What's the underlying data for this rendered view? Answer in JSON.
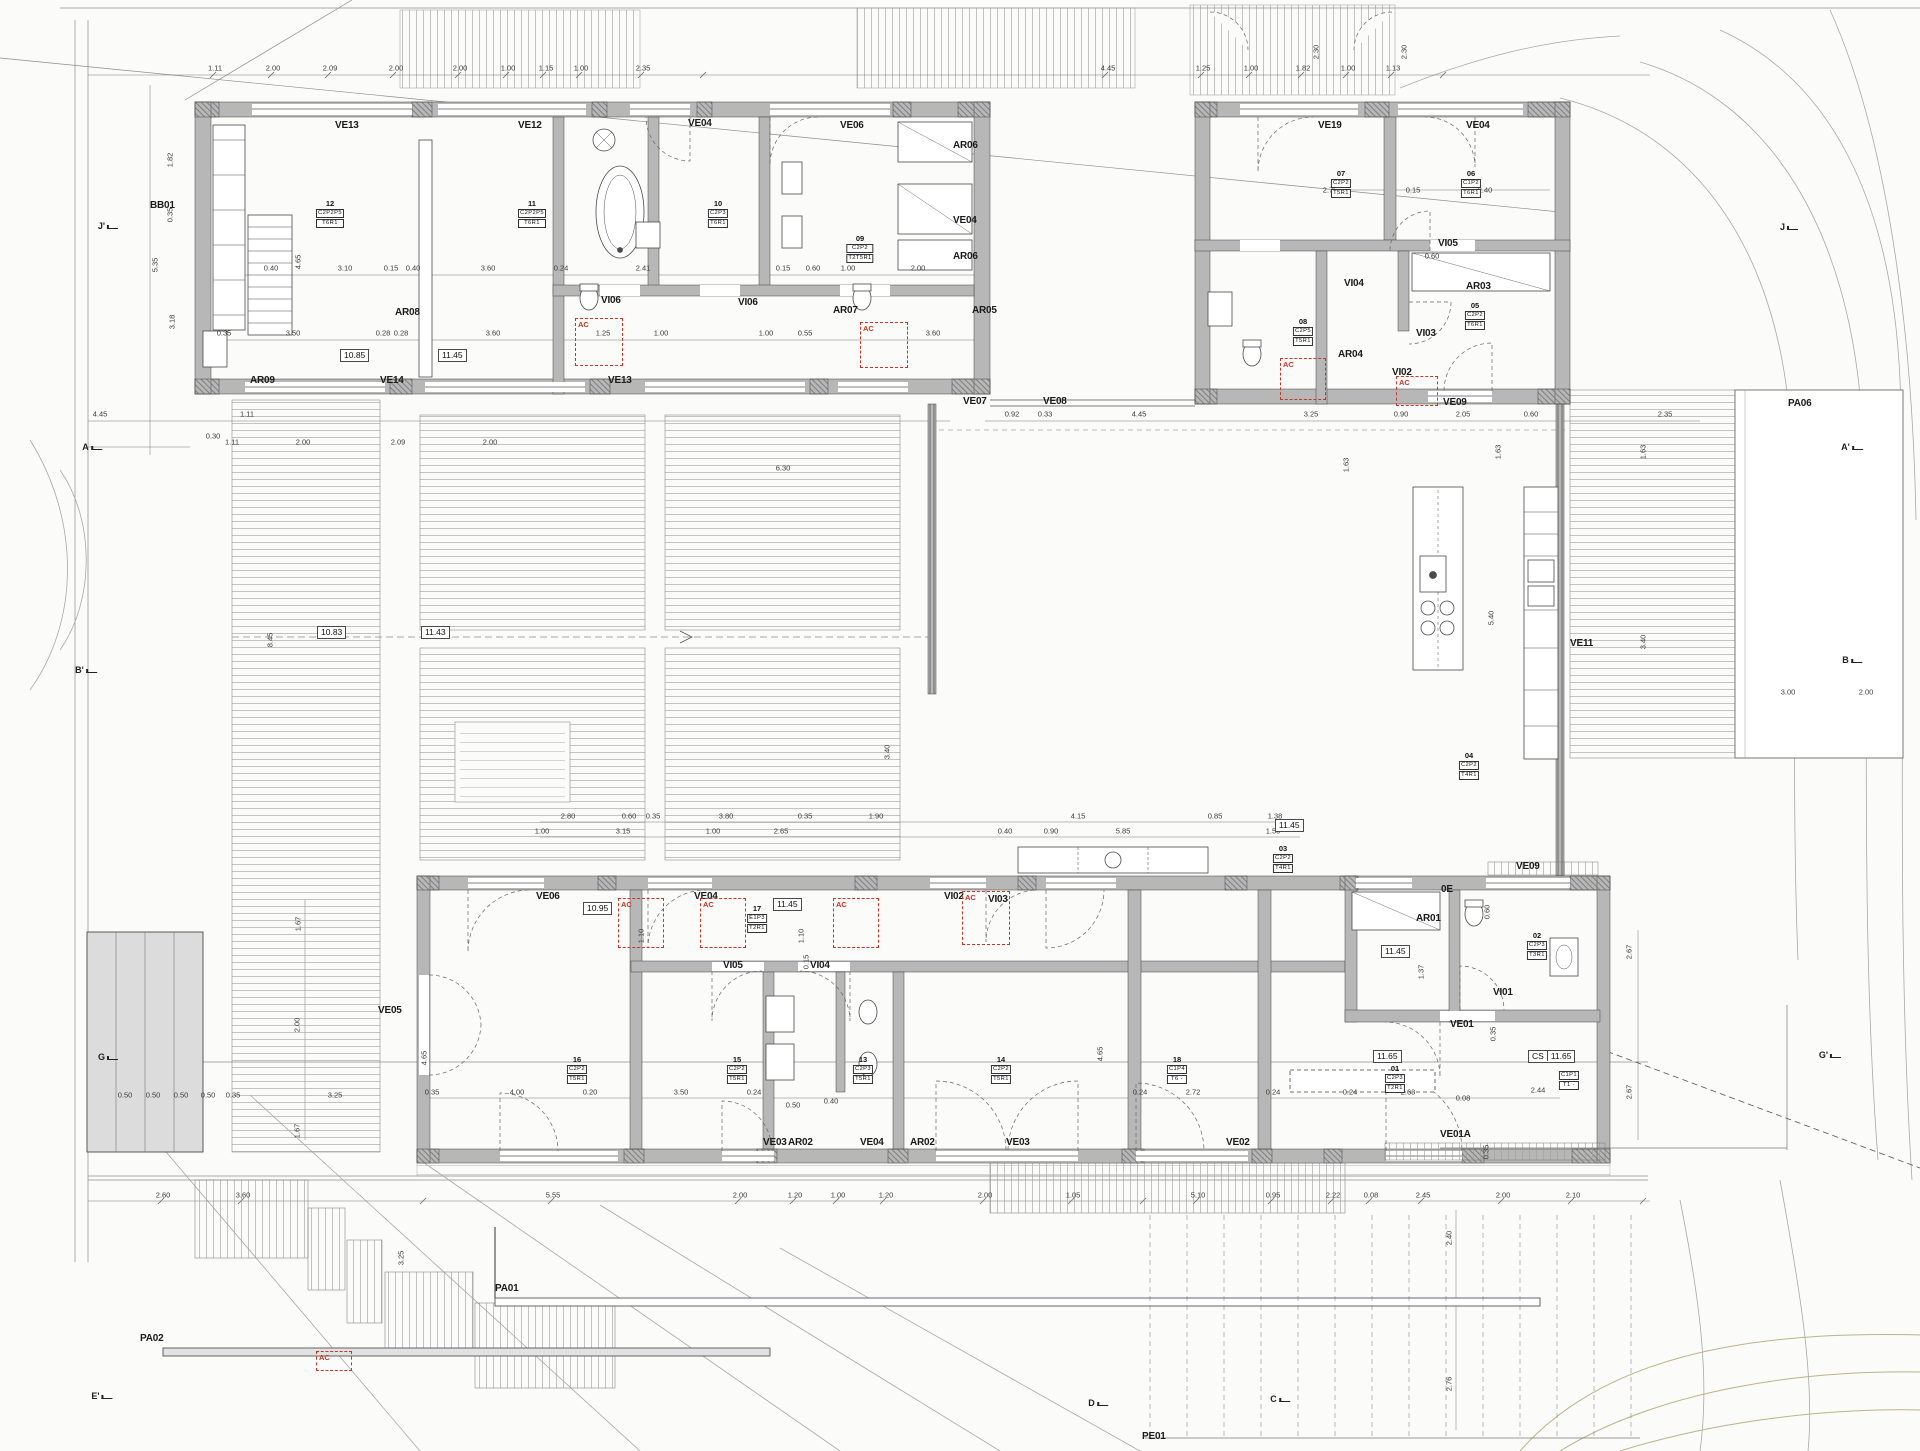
{
  "colors": {
    "wall_fill": "#b7b7b7",
    "pier_fill": "#9a9a9a",
    "line": "#555555",
    "deck_line": "#a9a9a9",
    "contour": "#a8a8a8",
    "vegetation": "#b9b489",
    "accent_red": "#c0392b",
    "paper": "#fbfbfa"
  },
  "ac_label": "AC",
  "ac_boxes": [
    {
      "x": 575,
      "y": 318,
      "w": 46,
      "h": 46
    },
    {
      "x": 860,
      "y": 322,
      "w": 46,
      "h": 44
    },
    {
      "x": 1280,
      "y": 358,
      "w": 44,
      "h": 40
    },
    {
      "x": 1396,
      "y": 376,
      "w": 40,
      "h": 28
    },
    {
      "x": 618,
      "y": 898,
      "w": 44,
      "h": 48
    },
    {
      "x": 700,
      "y": 898,
      "w": 44,
      "h": 48
    },
    {
      "x": 833,
      "y": 898,
      "w": 44,
      "h": 48
    },
    {
      "x": 962,
      "y": 891,
      "w": 46,
      "h": 52
    },
    {
      "x": 316,
      "y": 1351,
      "w": 34,
      "h": 18
    }
  ],
  "texts": {
    "bold": [
      {
        "t": "VE13",
        "x": 335,
        "y": 120
      },
      {
        "t": "VE12",
        "x": 518,
        "y": 120
      },
      {
        "t": "VE04",
        "x": 688,
        "y": 118
      },
      {
        "t": "VE06",
        "x": 840,
        "y": 120
      },
      {
        "t": "AR06",
        "x": 953,
        "y": 140
      },
      {
        "t": "VE04",
        "x": 953,
        "y": 215
      },
      {
        "t": "AR06",
        "x": 953,
        "y": 251
      },
      {
        "t": "AR05",
        "x": 972,
        "y": 305
      },
      {
        "t": "AR08",
        "x": 395,
        "y": 307
      },
      {
        "t": "AR07",
        "x": 833,
        "y": 305
      },
      {
        "t": "VI06",
        "x": 601,
        "y": 295
      },
      {
        "t": "VI06",
        "x": 738,
        "y": 297
      },
      {
        "t": "AR09",
        "x": 250,
        "y": 375
      },
      {
        "t": "VE14",
        "x": 380,
        "y": 375
      },
      {
        "t": "VE13",
        "x": 608,
        "y": 375
      },
      {
        "t": "BB01",
        "x": 150,
        "y": 200
      },
      {
        "t": "VE07",
        "x": 963,
        "y": 396
      },
      {
        "t": "VE08",
        "x": 1043,
        "y": 396
      },
      {
        "t": "VE19",
        "x": 1318,
        "y": 120
      },
      {
        "t": "VE04",
        "x": 1466,
        "y": 120
      },
      {
        "t": "VI05",
        "x": 1438,
        "y": 238
      },
      {
        "t": "VI04",
        "x": 1344,
        "y": 278
      },
      {
        "t": "AR03",
        "x": 1466,
        "y": 281
      },
      {
        "t": "VI03",
        "x": 1416,
        "y": 328
      },
      {
        "t": "AR04",
        "x": 1338,
        "y": 349
      },
      {
        "t": "VI02",
        "x": 1392,
        "y": 367
      },
      {
        "t": "VE09",
        "x": 1443,
        "y": 397
      },
      {
        "t": "VE11",
        "x": 1570,
        "y": 638
      },
      {
        "t": "PA06",
        "x": 1788,
        "y": 398
      },
      {
        "t": "VE09",
        "x": 1516,
        "y": 861
      },
      {
        "t": "VE06",
        "x": 536,
        "y": 891
      },
      {
        "t": "VE04",
        "x": 694,
        "y": 891
      },
      {
        "t": "VI02",
        "x": 944,
        "y": 891
      },
      {
        "t": "VI03",
        "x": 988,
        "y": 894
      },
      {
        "t": "VI05",
        "x": 723,
        "y": 960
      },
      {
        "t": "VI04",
        "x": 810,
        "y": 960
      },
      {
        "t": "AR01",
        "x": 1416,
        "y": 913
      },
      {
        "t": "0E",
        "x": 1441,
        "y": 884
      },
      {
        "t": "VE05",
        "x": 378,
        "y": 1005
      },
      {
        "t": "VE03",
        "x": 763,
        "y": 1137
      },
      {
        "t": "AR02",
        "x": 788,
        "y": 1137
      },
      {
        "t": "VE04",
        "x": 860,
        "y": 1137
      },
      {
        "t": "AR02",
        "x": 910,
        "y": 1137
      },
      {
        "t": "VE03",
        "x": 1006,
        "y": 1137
      },
      {
        "t": "VE02",
        "x": 1226,
        "y": 1137
      },
      {
        "t": "VE01",
        "x": 1450,
        "y": 1019
      },
      {
        "t": "VE01A",
        "x": 1440,
        "y": 1129
      },
      {
        "t": "VI01",
        "x": 1493,
        "y": 987
      },
      {
        "t": "PA01",
        "x": 495,
        "y": 1283
      },
      {
        "t": "PA02",
        "x": 140,
        "y": 1333
      },
      {
        "t": "PE01",
        "x": 1142,
        "y": 1431
      }
    ],
    "levels": [
      {
        "t": "10.85",
        "x": 340,
        "y": 349
      },
      {
        "t": "11.45",
        "x": 438,
        "y": 349
      },
      {
        "t": "10.83",
        "x": 317,
        "y": 626
      },
      {
        "t": "11.43",
        "x": 421,
        "y": 626
      },
      {
        "t": "10.95",
        "x": 583,
        "y": 902
      },
      {
        "t": "11.45",
        "x": 773,
        "y": 898
      },
      {
        "t": "11.45",
        "x": 1275,
        "y": 819
      },
      {
        "t": "11.45",
        "x": 1381,
        "y": 945
      },
      {
        "t": "11.65",
        "x": 1373,
        "y": 1050
      },
      {
        "p": "CS",
        "t": "11.65",
        "x": 1528,
        "y": 1050
      }
    ],
    "tags": [
      {
        "n": "12",
        "l1": "C2P2P5",
        "l2": "T6R1",
        "x": 330,
        "y": 200
      },
      {
        "n": "11",
        "l1": "C2P2P5",
        "l2": "T6R1",
        "x": 532,
        "y": 200
      },
      {
        "n": "10",
        "l1": "C2P3",
        "l2": "T6R1",
        "x": 718,
        "y": 200
      },
      {
        "n": "09",
        "l1": "C2P2",
        "l2": "T2T5R1",
        "x": 860,
        "y": 235
      },
      {
        "n": "08",
        "l1": "C2P5",
        "l2": "T5R1",
        "x": 1303,
        "y": 318
      },
      {
        "n": "07",
        "l1": "C2P2",
        "l2": "T5R1",
        "x": 1341,
        "y": 170
      },
      {
        "n": "06",
        "l1": "C1P2",
        "l2": "T6R1",
        "x": 1471,
        "y": 170
      },
      {
        "n": "05",
        "l1": "C2P2",
        "l2": "T6R1",
        "x": 1475,
        "y": 302
      },
      {
        "n": "04",
        "l1": "C2P2",
        "l2": "T4R1",
        "x": 1469,
        "y": 752
      },
      {
        "n": "03",
        "l1": "C2P2",
        "l2": "T4R1",
        "x": 1283,
        "y": 845
      },
      {
        "n": "02",
        "l1": "C2P3",
        "l2": "T3R1",
        "x": 1537,
        "y": 932
      },
      {
        "n": "01",
        "l1": "C2P3",
        "l2": "T2R1",
        "x": 1395,
        "y": 1065
      },
      {
        "n": "16",
        "l1": "C2P2",
        "l2": "T5R1",
        "x": 577,
        "y": 1056
      },
      {
        "n": "15",
        "l1": "C2P2",
        "l2": "T5R1",
        "x": 737,
        "y": 1056
      },
      {
        "n": "13",
        "l1": "C2P3",
        "l2": "T5R1",
        "x": 863,
        "y": 1056
      },
      {
        "n": "14",
        "l1": "C2P2",
        "l2": "T5R1",
        "x": 1001,
        "y": 1056
      },
      {
        "n": "17",
        "l1": "E1P3",
        "l2": "T2R1",
        "x": 757,
        "y": 905
      },
      {
        "n": "18",
        "l1": "C1P4",
        "l2": "T6 -",
        "x": 1177,
        "y": 1056
      },
      {
        "n": "",
        "l1": "C1P1",
        "l2": "T1 -",
        "x": 1569,
        "y": 1070
      }
    ],
    "sections": [
      {
        "t": "A",
        "x": 92,
        "y": 447
      },
      {
        "t": "A'",
        "x": 1852,
        "y": 447
      },
      {
        "t": "B",
        "x": 1852,
        "y": 660
      },
      {
        "t": "B'",
        "x": 86,
        "y": 670
      },
      {
        "t": "G",
        "x": 108,
        "y": 1057
      },
      {
        "t": "G'",
        "x": 1830,
        "y": 1055
      },
      {
        "t": "J",
        "x": 1789,
        "y": 227
      },
      {
        "t": "J'",
        "x": 108,
        "y": 226
      },
      {
        "t": "C",
        "x": 1280,
        "y": 1399
      },
      {
        "t": "D",
        "x": 1098,
        "y": 1403
      },
      {
        "t": "E'",
        "x": 102,
        "y": 1396
      }
    ],
    "dims": [
      {
        "t": "1.11",
        "x": 215,
        "y": 68
      },
      {
        "t": "2.00",
        "x": 273,
        "y": 68
      },
      {
        "t": "2.09",
        "x": 330,
        "y": 68
      },
      {
        "t": "2.00",
        "x": 396,
        "y": 68
      },
      {
        "t": "2.00",
        "x": 460,
        "y": 68
      },
      {
        "t": "1.00",
        "x": 508,
        "y": 68
      },
      {
        "t": "1.15",
        "x": 546,
        "y": 68
      },
      {
        "t": "1.00",
        "x": 581,
        "y": 68
      },
      {
        "t": "2.35",
        "x": 643,
        "y": 68
      },
      {
        "t": "4.45",
        "x": 1108,
        "y": 68
      },
      {
        "t": "1.25",
        "x": 1203,
        "y": 68
      },
      {
        "t": "1.00",
        "x": 1251,
        "y": 68
      },
      {
        "t": "1.82",
        "x": 1303,
        "y": 68
      },
      {
        "t": "1.00",
        "x": 1348,
        "y": 68
      },
      {
        "t": "1.13",
        "x": 1393,
        "y": 68
      },
      {
        "t": "2.30",
        "x": 1316,
        "y": 52,
        "r": 1
      },
      {
        "t": "2.30",
        "x": 1404,
        "y": 52,
        "r": 1
      },
      {
        "t": "1.82",
        "x": 170,
        "y": 160,
        "r": 1
      },
      {
        "t": "0.35",
        "x": 170,
        "y": 215,
        "r": 1
      },
      {
        "t": "5.35",
        "x": 155,
        "y": 265,
        "r": 1
      },
      {
        "t": "3.18",
        "x": 172,
        "y": 322,
        "r": 1
      },
      {
        "t": "4.65",
        "x": 298,
        "y": 262,
        "r": 1
      },
      {
        "t": "4.45",
        "x": 100,
        "y": 414
      },
      {
        "t": "0.30",
        "x": 213,
        "y": 436
      },
      {
        "t": "1.11",
        "x": 247,
        "y": 414
      },
      {
        "t": "0.40",
        "x": 271,
        "y": 268
      },
      {
        "t": "3.10",
        "x": 345,
        "y": 268
      },
      {
        "t": "0.15",
        "x": 391,
        "y": 268
      },
      {
        "t": "0.40",
        "x": 413,
        "y": 268
      },
      {
        "t": "3.60",
        "x": 488,
        "y": 268
      },
      {
        "t": "0.24",
        "x": 561,
        "y": 268
      },
      {
        "t": "2.41",
        "x": 643,
        "y": 268
      },
      {
        "t": "0.15",
        "x": 783,
        "y": 268
      },
      {
        "t": "0.60",
        "x": 813,
        "y": 268
      },
      {
        "t": "1.00",
        "x": 848,
        "y": 268
      },
      {
        "t": "2.00",
        "x": 918,
        "y": 268
      },
      {
        "t": "0.35",
        "x": 224,
        "y": 333
      },
      {
        "t": "3.50",
        "x": 293,
        "y": 333
      },
      {
        "t": "0.28",
        "x": 383,
        "y": 333
      },
      {
        "t": "0.28",
        "x": 401,
        "y": 333
      },
      {
        "t": "3.60",
        "x": 493,
        "y": 333
      },
      {
        "t": "1.25",
        "x": 603,
        "y": 333
      },
      {
        "t": "1.00",
        "x": 661,
        "y": 333
      },
      {
        "t": "1.00",
        "x": 766,
        "y": 333
      },
      {
        "t": "0.55",
        "x": 805,
        "y": 333
      },
      {
        "t": "3.60",
        "x": 933,
        "y": 333
      },
      {
        "t": "2.75",
        "x": 1330,
        "y": 190
      },
      {
        "t": "0.15",
        "x": 1413,
        "y": 190
      },
      {
        "t": "2.40",
        "x": 1485,
        "y": 190
      },
      {
        "t": "0.60",
        "x": 1432,
        "y": 256
      },
      {
        "t": "0.92",
        "x": 1012,
        "y": 414
      },
      {
        "t": "0.33",
        "x": 1045,
        "y": 414
      },
      {
        "t": "4.45",
        "x": 1139,
        "y": 414
      },
      {
        "t": "3.25",
        "x": 1311,
        "y": 414
      },
      {
        "t": "0.90",
        "x": 1401,
        "y": 414
      },
      {
        "t": "2.05",
        "x": 1463,
        "y": 414
      },
      {
        "t": "0.60",
        "x": 1531,
        "y": 414
      },
      {
        "t": "2.35",
        "x": 1665,
        "y": 414
      },
      {
        "t": "1.11",
        "x": 232,
        "y": 442
      },
      {
        "t": "2.00",
        "x": 303,
        "y": 442
      },
      {
        "t": "2.09",
        "x": 398,
        "y": 442
      },
      {
        "t": "2.00",
        "x": 490,
        "y": 442
      },
      {
        "t": "6.30",
        "x": 783,
        "y": 468
      },
      {
        "t": "8.45",
        "x": 270,
        "y": 640,
        "r": 1
      },
      {
        "t": "3.40",
        "x": 887,
        "y": 752,
        "r": 1
      },
      {
        "t": "1.63",
        "x": 1346,
        "y": 465,
        "r": 1
      },
      {
        "t": "1.63",
        "x": 1498,
        "y": 452,
        "r": 1
      },
      {
        "t": "1.63",
        "x": 1643,
        "y": 452,
        "r": 1
      },
      {
        "t": "5.40",
        "x": 1491,
        "y": 618,
        "r": 1
      },
      {
        "t": "3.40",
        "x": 1643,
        "y": 642,
        "r": 1
      },
      {
        "t": "3.00",
        "x": 1788,
        "y": 692
      },
      {
        "t": "2.00",
        "x": 1866,
        "y": 692
      },
      {
        "t": "2.80",
        "x": 568,
        "y": 816
      },
      {
        "t": "0.60",
        "x": 629,
        "y": 816
      },
      {
        "t": "0.35",
        "x": 653,
        "y": 816
      },
      {
        "t": "3.80",
        "x": 726,
        "y": 816
      },
      {
        "t": "0.35",
        "x": 805,
        "y": 816
      },
      {
        "t": "1.90",
        "x": 876,
        "y": 816
      },
      {
        "t": "4.15",
        "x": 1078,
        "y": 816
      },
      {
        "t": "0.85",
        "x": 1215,
        "y": 816
      },
      {
        "t": "1.38",
        "x": 1275,
        "y": 816
      },
      {
        "t": "1.00",
        "x": 542,
        "y": 831
      },
      {
        "t": "3.15",
        "x": 623,
        "y": 831
      },
      {
        "t": "1.00",
        "x": 713,
        "y": 831
      },
      {
        "t": "2.65",
        "x": 781,
        "y": 831
      },
      {
        "t": "0.40",
        "x": 1005,
        "y": 831
      },
      {
        "t": "0.90",
        "x": 1051,
        "y": 831
      },
      {
        "t": "5.85",
        "x": 1123,
        "y": 831
      },
      {
        "t": "1.50",
        "x": 1273,
        "y": 831
      },
      {
        "t": "1.10",
        "x": 641,
        "y": 936,
        "r": 1
      },
      {
        "t": "1.10",
        "x": 801,
        "y": 936,
        "r": 1
      },
      {
        "t": "0.15",
        "x": 806,
        "y": 962,
        "r": 1
      },
      {
        "t": "4.65",
        "x": 424,
        "y": 1058,
        "r": 1
      },
      {
        "t": "4.65",
        "x": 1100,
        "y": 1054,
        "r": 1
      },
      {
        "t": "0.35",
        "x": 432,
        "y": 1092
      },
      {
        "t": "4.00",
        "x": 517,
        "y": 1092
      },
      {
        "t": "0.20",
        "x": 590,
        "y": 1092
      },
      {
        "t": "3.50",
        "x": 681,
        "y": 1092
      },
      {
        "t": "0.24",
        "x": 754,
        "y": 1092
      },
      {
        "t": "0.24",
        "x": 1140,
        "y": 1092
      },
      {
        "t": "2.72",
        "x": 1193,
        "y": 1092
      },
      {
        "t": "0.24",
        "x": 1273,
        "y": 1092
      },
      {
        "t": "0.24",
        "x": 1350,
        "y": 1092
      },
      {
        "t": "2.63",
        "x": 1408,
        "y": 1092
      },
      {
        "t": "0.08",
        "x": 1463,
        "y": 1098
      },
      {
        "t": "2.44",
        "x": 1538,
        "y": 1090
      },
      {
        "t": "0.50",
        "x": 793,
        "y": 1105
      },
      {
        "t": "0.40",
        "x": 831,
        "y": 1101
      },
      {
        "t": "1.37",
        "x": 1421,
        "y": 972,
        "r": 1
      },
      {
        "t": "0.60",
        "x": 1487,
        "y": 912,
        "r": 1
      },
      {
        "t": "0.35",
        "x": 1493,
        "y": 1034,
        "r": 1
      },
      {
        "t": "0.35",
        "x": 1486,
        "y": 1152,
        "r": 1
      },
      {
        "t": "2.67",
        "x": 1629,
        "y": 952,
        "r": 1
      },
      {
        "t": "2.67",
        "x": 1629,
        "y": 1092,
        "r": 1
      },
      {
        "t": "2.40",
        "x": 1449,
        "y": 1238,
        "r": 1
      },
      {
        "t": "2.76",
        "x": 1449,
        "y": 1384,
        "r": 1
      },
      {
        "t": "2.60",
        "x": 163,
        "y": 1195
      },
      {
        "t": "3.60",
        "x": 243,
        "y": 1195
      },
      {
        "t": "5.55",
        "x": 553,
        "y": 1195
      },
      {
        "t": "2.00",
        "x": 740,
        "y": 1195
      },
      {
        "t": "1.20",
        "x": 795,
        "y": 1195
      },
      {
        "t": "1.00",
        "x": 838,
        "y": 1195
      },
      {
        "t": "1.20",
        "x": 886,
        "y": 1195
      },
      {
        "t": "2.00",
        "x": 985,
        "y": 1195
      },
      {
        "t": "1.05",
        "x": 1073,
        "y": 1195
      },
      {
        "t": "5.10",
        "x": 1198,
        "y": 1195
      },
      {
        "t": "0.95",
        "x": 1273,
        "y": 1195
      },
      {
        "t": "2.22",
        "x": 1333,
        "y": 1195
      },
      {
        "t": "0.08",
        "x": 1371,
        "y": 1195
      },
      {
        "t": "2.45",
        "x": 1423,
        "y": 1195
      },
      {
        "t": "2.00",
        "x": 1503,
        "y": 1195
      },
      {
        "t": "2.10",
        "x": 1573,
        "y": 1195
      },
      {
        "t": "0.50",
        "x": 125,
        "y": 1095
      },
      {
        "t": "0.50",
        "x": 153,
        "y": 1095
      },
      {
        "t": "0.50",
        "x": 181,
        "y": 1095
      },
      {
        "t": "0.50",
        "x": 208,
        "y": 1095
      },
      {
        "t": "0.35",
        "x": 233,
        "y": 1095
      },
      {
        "t": "3.25",
        "x": 335,
        "y": 1095
      },
      {
        "t": "1.67",
        "x": 298,
        "y": 924,
        "r": 1
      },
      {
        "t": "2.00",
        "x": 297,
        "y": 1025,
        "r": 1
      },
      {
        "t": "1.67",
        "x": 297,
        "y": 1131,
        "r": 1
      },
      {
        "t": "3.25",
        "x": 401,
        "y": 1258,
        "r": 1
      }
    ]
  }
}
